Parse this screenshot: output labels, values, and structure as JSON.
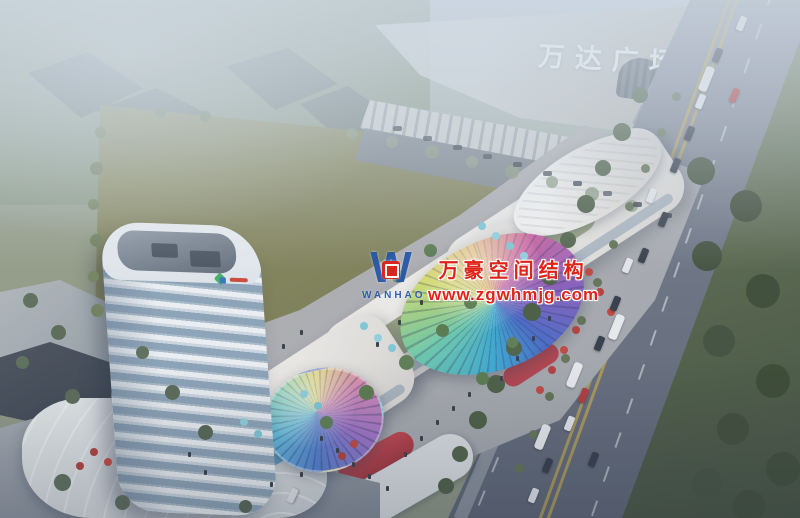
{
  "scene": {
    "description": "Aerial dusk rendering of a new mixed-use commercial complex beside Wanda Plaza",
    "mall_sign": {
      "text": "万达广场"
    },
    "watermark": {
      "logo_monogram": "W",
      "logo_wordmark": "WANHAO",
      "company": "万豪空间结构",
      "website": "www.zgwhmjg.com",
      "text_color": "#e02318",
      "logo_blue": "#2456a8",
      "badge_red": "#d8281e"
    },
    "tower_brand_colors": [
      "#3fae62",
      "#2e6fc0",
      "#d0402e"
    ],
    "palette": {
      "haze": "#cdd8e4",
      "field_green": "#7d7e52",
      "road_grey": "#6a7180",
      "tree_green": "#4a5c40",
      "belt_green": "#46553d",
      "building_white": "#f0ede8",
      "tower_glass": "#8ba2b6",
      "accent_red": "#b5303a",
      "canopy_rainbow": [
        "#2fa8d4",
        "#62c9a8",
        "#d6de62",
        "#eab052",
        "#d2569c",
        "#8356bc",
        "#3c63c8"
      ]
    }
  }
}
